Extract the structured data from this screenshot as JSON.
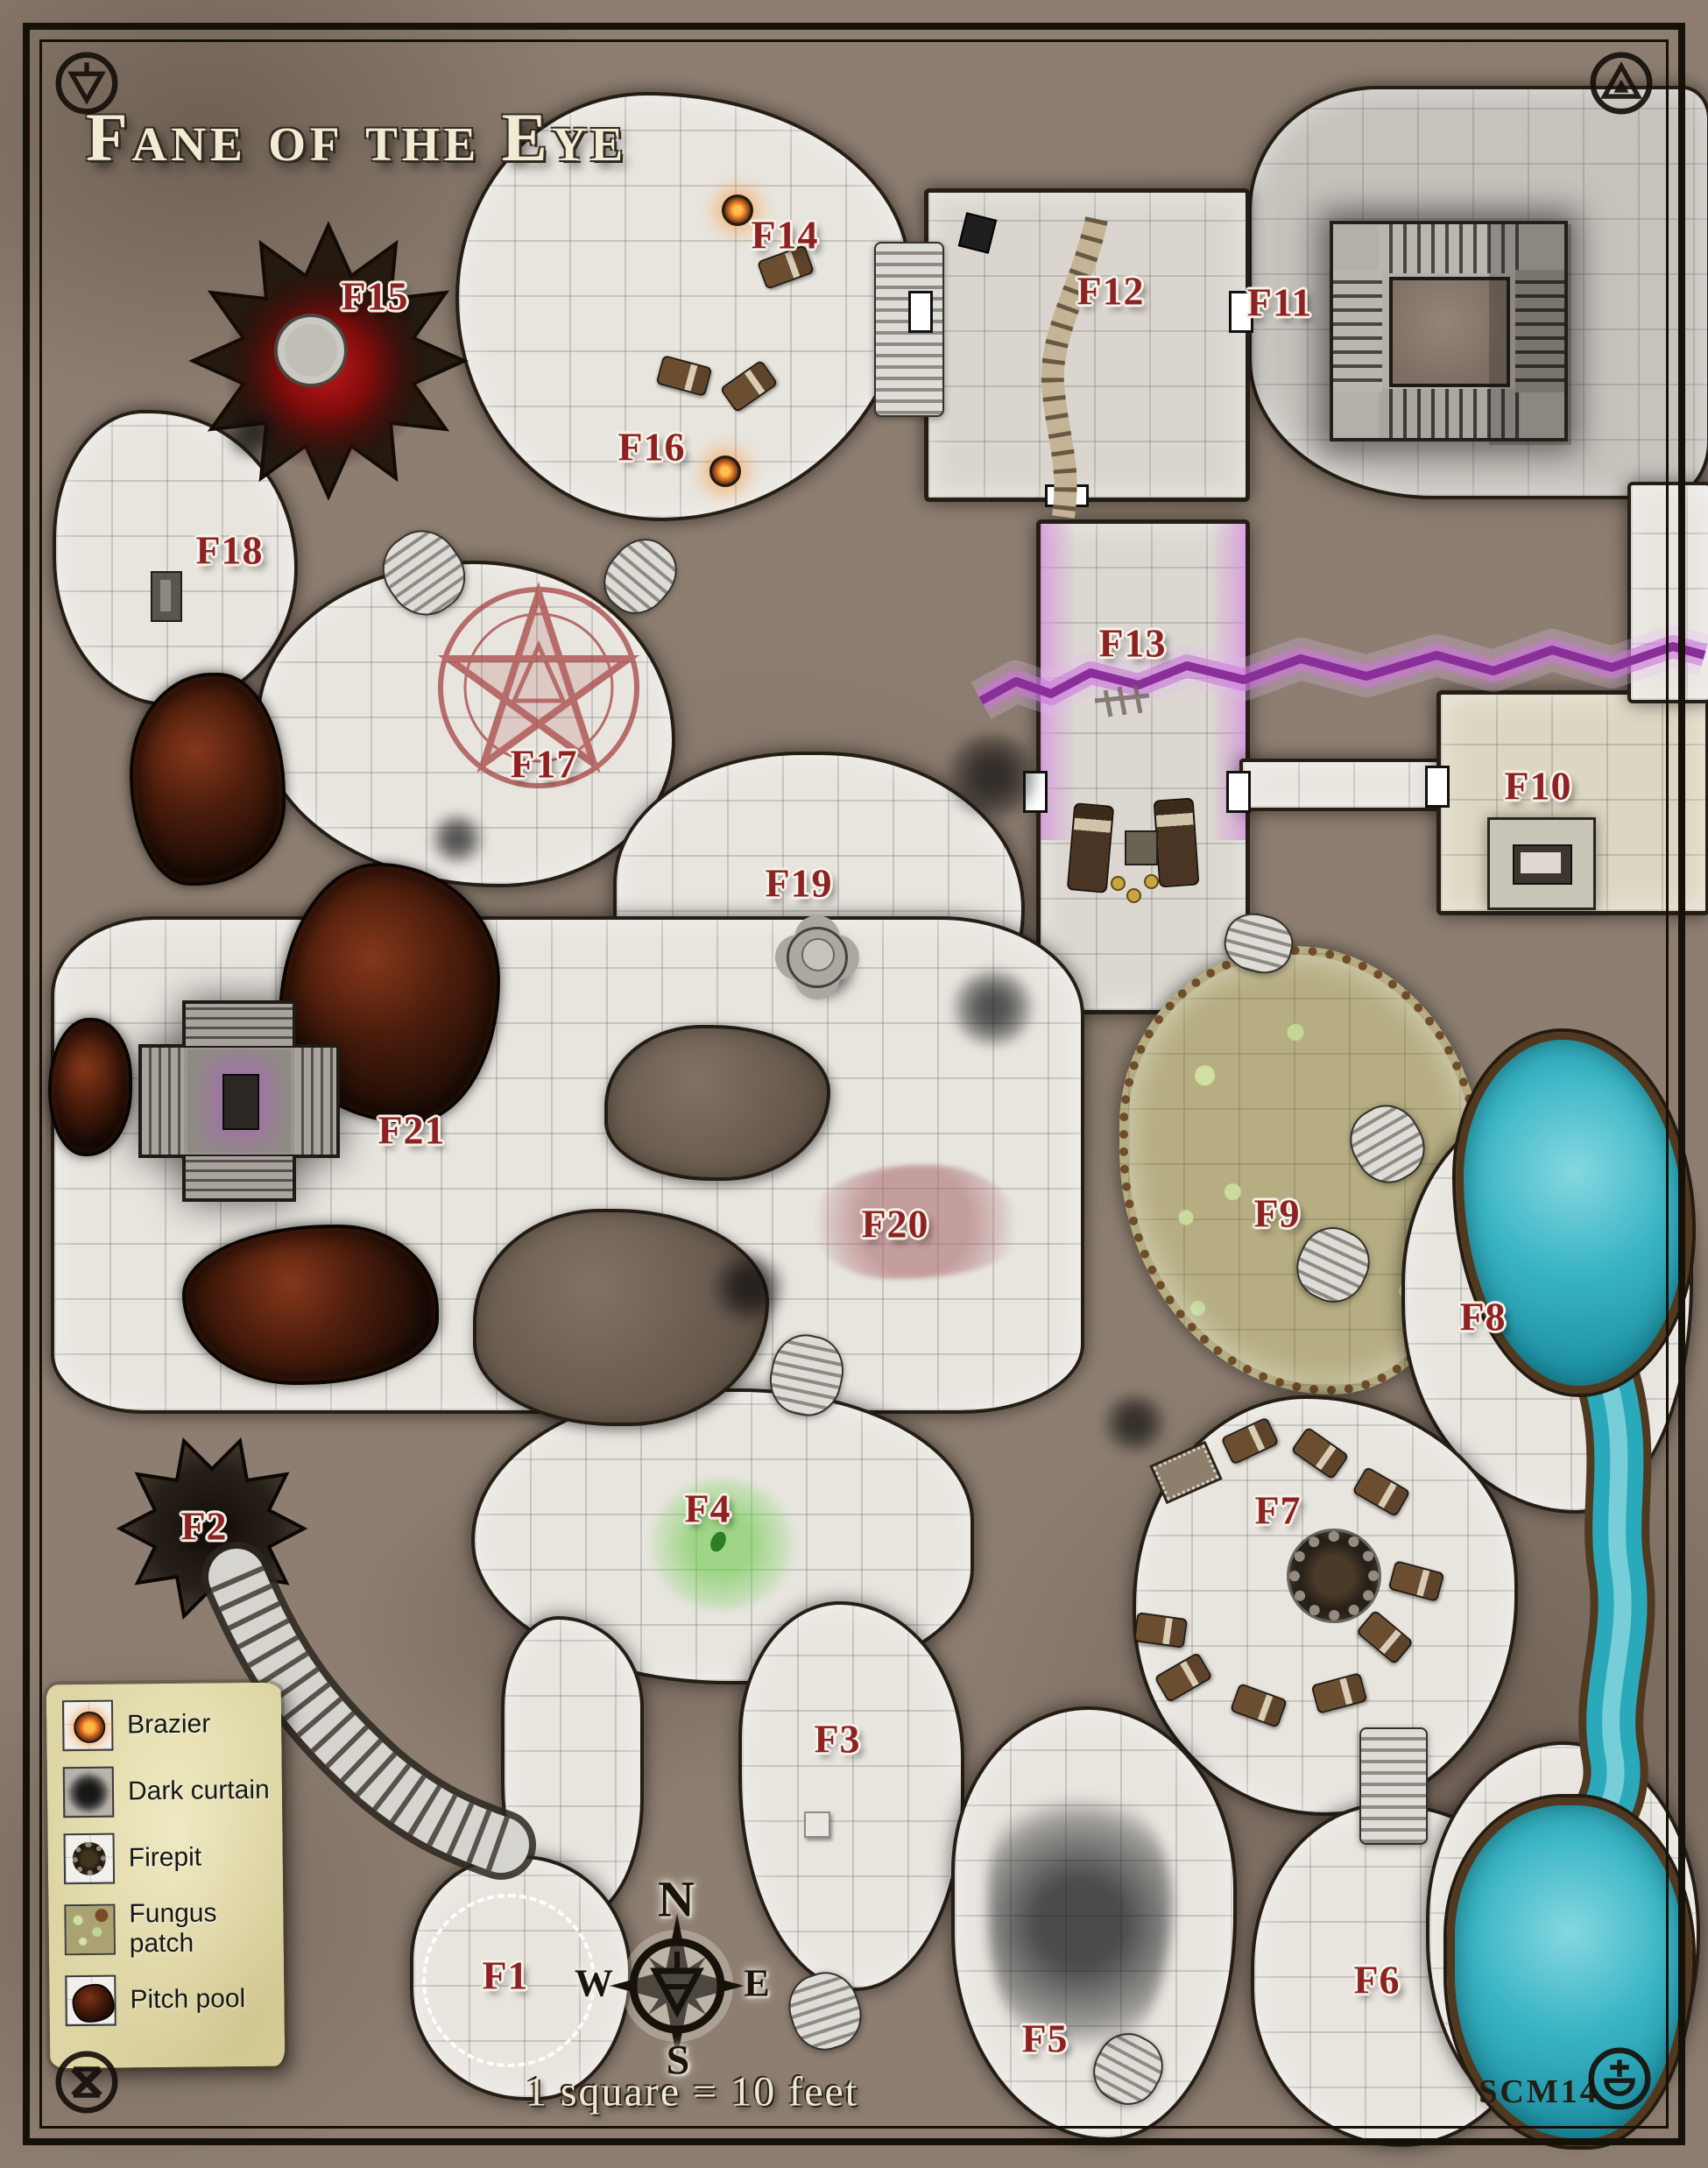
{
  "title": "Fane of the Eye",
  "map": {
    "room_labels": [
      "F1",
      "F2",
      "F3",
      "F4",
      "F5",
      "F6",
      "F7",
      "F8",
      "F9",
      "F10",
      "F11",
      "F12",
      "F13",
      "F14",
      "F15",
      "F16",
      "F17",
      "F18",
      "F19",
      "F20",
      "F21"
    ],
    "compass": {
      "north": "N",
      "east": "E",
      "south": "S",
      "west": "W"
    },
    "scale_text": "1 square = 10 feet",
    "signature": "SCM14"
  },
  "legend": {
    "items": [
      {
        "label": "Brazier",
        "icon": "brazier-icon"
      },
      {
        "label": "Dark curtain",
        "icon": "dark-curtain-icon"
      },
      {
        "label": "Firepit",
        "icon": "firepit-icon"
      },
      {
        "label": "Fungus patch",
        "icon": "fungus-patch-icon"
      },
      {
        "label": "Pitch pool",
        "icon": "pitch-pool-icon"
      }
    ]
  },
  "colors": {
    "label_red": "#8e2222",
    "title_cream": "#f1ebd4",
    "water_teal": "#2aa9ba",
    "crack_purple": "#c167cf",
    "fungus_olive": "#b6ae82",
    "legend_parchment": "#ddd6a4"
  }
}
